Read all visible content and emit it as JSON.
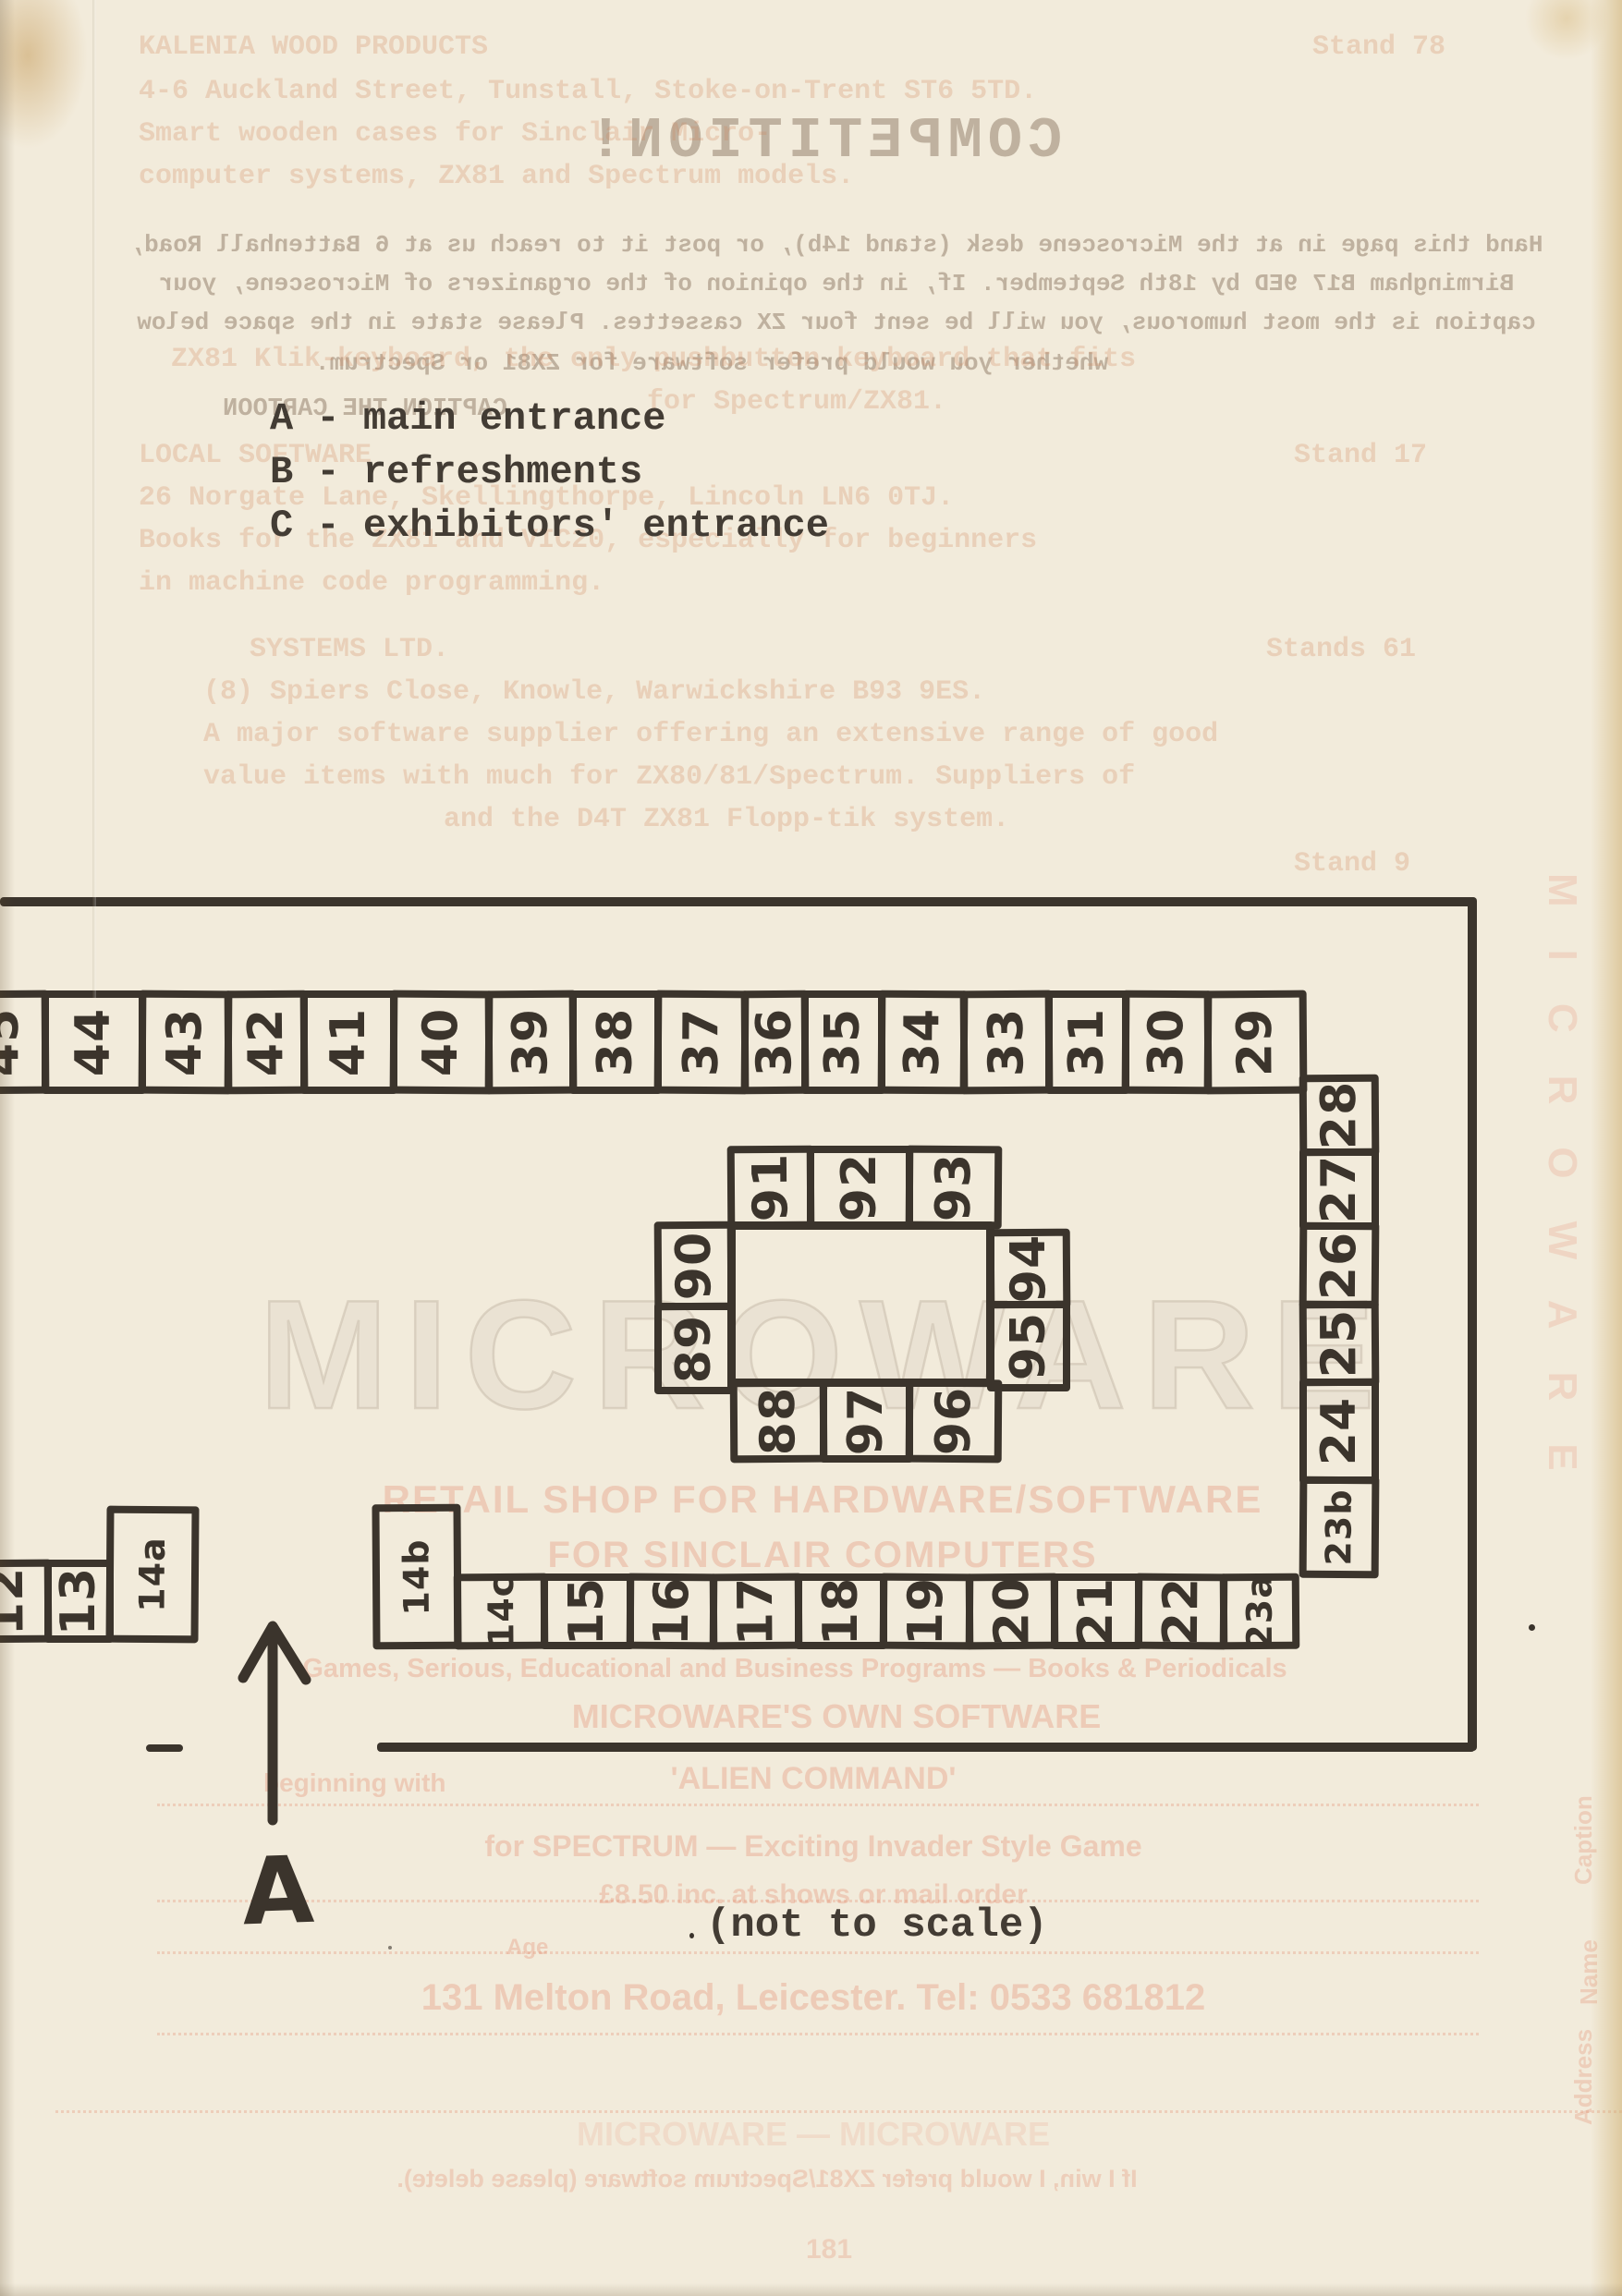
{
  "legend": {
    "items": [
      "A - main entrance",
      "B - refreshments",
      "C - exhibitors' entrance"
    ]
  },
  "map": {
    "note": "(not to scale)",
    "entrance_label": "A",
    "stands": {
      "top_row": [
        "45",
        "44",
        "43",
        "42",
        "41",
        "40",
        "39",
        "38",
        "37",
        "36",
        "35",
        "34",
        "33",
        "31",
        "30",
        "29"
      ],
      "right_column": [
        "28",
        "27",
        "26",
        "25",
        "24",
        "23b"
      ],
      "island_top": [
        "91",
        "92",
        "93"
      ],
      "island_left": [
        "90",
        "89"
      ],
      "island_right": [
        "94",
        "95"
      ],
      "island_bottom": [
        "88",
        "97",
        "96"
      ],
      "stand_14b": [
        "14b"
      ],
      "bottom_row": [
        "14c",
        "15",
        "16",
        "17",
        "18",
        "19",
        "20",
        "21",
        "22",
        "23a"
      ],
      "left_group": [
        "12",
        "13",
        "14a"
      ]
    }
  },
  "colors": {
    "paper": "#f2ebdb",
    "ink": "#3b342c",
    "ghost_grey": "#96816e",
    "ghost_orange": "#cf825a",
    "ghost_pink": "#e28a6e"
  },
  "ghost": {
    "texts": [
      "COMPETITION!",
      "Hand this page in at the Microscene desk (stand 14b), or post it to reach us at 6 Battenhall Road,",
      "Birmingham B17 9ED by 18th September. If, in the opinion of the organizers of Microscene, your",
      "caption is the most humorous, you will be sent four ZX cassettes. Please state in the space below",
      "whether you would prefer software for ZX81 or Spectrum.",
      "CAPTION THE CARTOON",
      "KALENIA WOOD PRODUCTS",
      "Stand 78",
      "4-6 Auckland Street, Tunstall, Stoke-on-Trent ST6 5TD.",
      "Smart wooden cases for Sinclair Micro-",
      "computer systems, ZX81 and Spectrum models.",
      "ZX81 Klik-keyboard, the only pushbutton keyboard that fits",
      "for Spectrum/ZX81.",
      "LOCAL SOFTWARE",
      "Stand 17",
      "26 Norgate Lane, Skellingthorpe, Lincoln LN6 0TJ.",
      "Books for the ZX81 and VIC20, especially for beginners",
      "in machine code programming.",
      "SYSTEMS LTD.",
      "Stands 61",
      "(8) Spiers Close, Knowle, Warwickshire B93 9ES.",
      "A major software supplier offering an extensive range of good",
      "value items with much for ZX80/81/Spectrum. Suppliers of",
      "and the D4T ZX81 Flopp-tik system.",
      "Stand 9",
      "MICROWARE",
      "RETAIL SHOP FOR HARDWARE/SOFTWARE",
      "FOR SINCLAIR COMPUTERS",
      "Games, Serious, Educational and Business Programs — Books & Periodicals",
      "MICROWARE'S OWN SOFTWARE",
      "beginning with",
      "'ALIEN COMMAND'",
      "for SPECTRUM — Exciting Invader Style Game",
      "£8.50 inc. at shows or mail order",
      "Age",
      "131 Melton Road, Leicester. Tel: 0533 681812",
      "Caption",
      "Name",
      "Address",
      "MICROWARE",
      "MICROWARE — MICROWARE",
      "If I win, I would prefer ZX81/Spectrum software (please delete).",
      "181"
    ]
  }
}
